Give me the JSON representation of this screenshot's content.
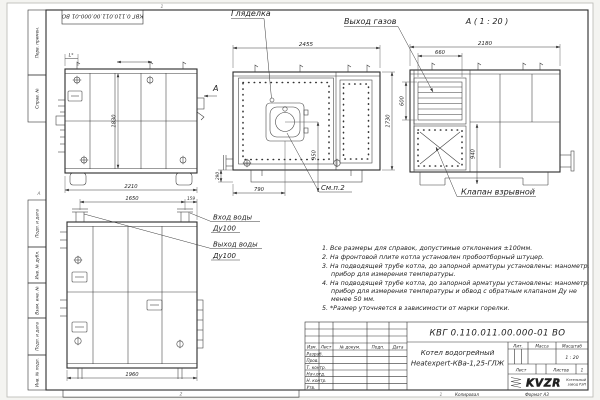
{
  "designation": "КВГ 0.110.011.00.000-01 ВО",
  "frame": {
    "zone_top": "1",
    "zone_bottom": "2",
    "zone_sheet": "1",
    "fold_mark": "А"
  },
  "margin_stamps": [
    "Перв. примен.",
    "Справ. №",
    "Подп. и дата",
    "Инв. № дубл.",
    "Взам. инв. №",
    "Подп. и дата",
    "Инв. № подл."
  ],
  "views": {
    "side": {
      "dim_l": "L*",
      "dim_height": "1830",
      "dim_width": "2210",
      "section_label": "А"
    },
    "front": {
      "label_sight_glass": "Гляделка",
      "dim_width": "2455",
      "dim_height": "1730",
      "dim_burner": "950",
      "dim_burner_offset": "790",
      "dim_base": "290",
      "label_see_item": "См.п.2"
    },
    "rear": {
      "view_title": "А ( 1 : 20 )",
      "label_flue": "Выход газов",
      "dim_width": "2180",
      "dim_flue_w": "660",
      "dim_flue_h": "600",
      "dim_valve": "940",
      "label_valve": "Клапан взрывной"
    },
    "back": {
      "dim_span": "1650",
      "dim_offset": "159",
      "dim_width": "1960",
      "inlet_line1": "Вход воды",
      "inlet_line2": "Ду100",
      "outlet_line1": "Выход воды",
      "outlet_line2": "Ду100"
    }
  },
  "notes": [
    "1. Все размеры для справок, допустимые отклонения ±100мм.",
    "2. На фронтовой плите котла установлен пробоотборный штуцер.",
    "3. На подводящей трубе котла, до запорной арматуры установлены: манометр, прибор для измерения температуры.",
    "4. На подводящей трубе котла, до запорной арматуры установлены: манометр, прибор для измерения температуры и обвод с обратным клапаном Ду не менее 50 мм.",
    "5. *Размер уточняется в зависимости от марки горелки."
  ],
  "title_block": {
    "name_line1": "Котел водогрейный",
    "name_line2": "Heatexpert-КВа-1,25-ГЛЖ",
    "col_izm": "Изм.",
    "col_list": "Лист",
    "col_doc": "№ докум.",
    "col_podp": "Подп.",
    "col_data": "Дата",
    "rows": [
      "Разраб.",
      "Пров.",
      "Т. контр.",
      "Нач.отд.",
      "Н. контр.",
      "Утв."
    ],
    "lit": "Лит.",
    "mass": "Масса",
    "scale_label": "Масштаб",
    "scale": "1 : 20",
    "sheet_label": "Лист",
    "sheets_label": "Листов",
    "sheets_value": "1",
    "logo": "KVZR",
    "logo_caption1": "Котельный",
    "logo_caption2": "завод РЭП",
    "copied": "Копировал",
    "format": "Формат А3"
  }
}
